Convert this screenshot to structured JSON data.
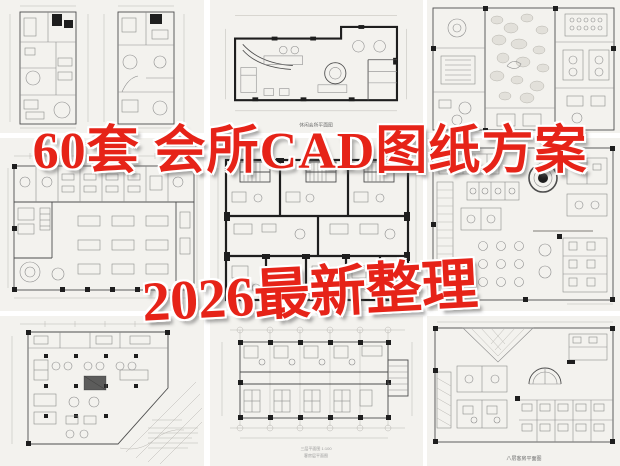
{
  "poster": {
    "headline_top": "60套 会所CAD图纸方案",
    "headline_bottom": "2026最新整理",
    "accent_color": "#e62318",
    "outline_color": "#ffffff",
    "paper_color": "#f3f2ee",
    "line_color": "#4d4d4d"
  },
  "captions": {
    "top_middle": "休闲会所平面图",
    "bottom_middle_line1": "三层平面图 1:100",
    "bottom_middle_line2": "客房层平面图",
    "bottom_right": "八层客房平面图"
  },
  "tiles": [
    {
      "id": 1,
      "name": "two-tall-villa-floor-plans"
    },
    {
      "id": 2,
      "name": "leisure-club-floor-plan"
    },
    {
      "id": 3,
      "name": "courtyard-club-plan-with-stone-paving"
    },
    {
      "id": 4,
      "name": "wide-club-hall-plan"
    },
    {
      "id": 5,
      "name": "thick-wall-guestroom-plan-with-stairs"
    },
    {
      "id": 6,
      "name": "dense-restaurant-plan-with-round-tables"
    },
    {
      "id": 7,
      "name": "angled-site-club-plan"
    },
    {
      "id": 8,
      "name": "column-grid-guestroom-plan"
    },
    {
      "id": 9,
      "name": "eighth-floor-guestroom-plan"
    }
  ]
}
